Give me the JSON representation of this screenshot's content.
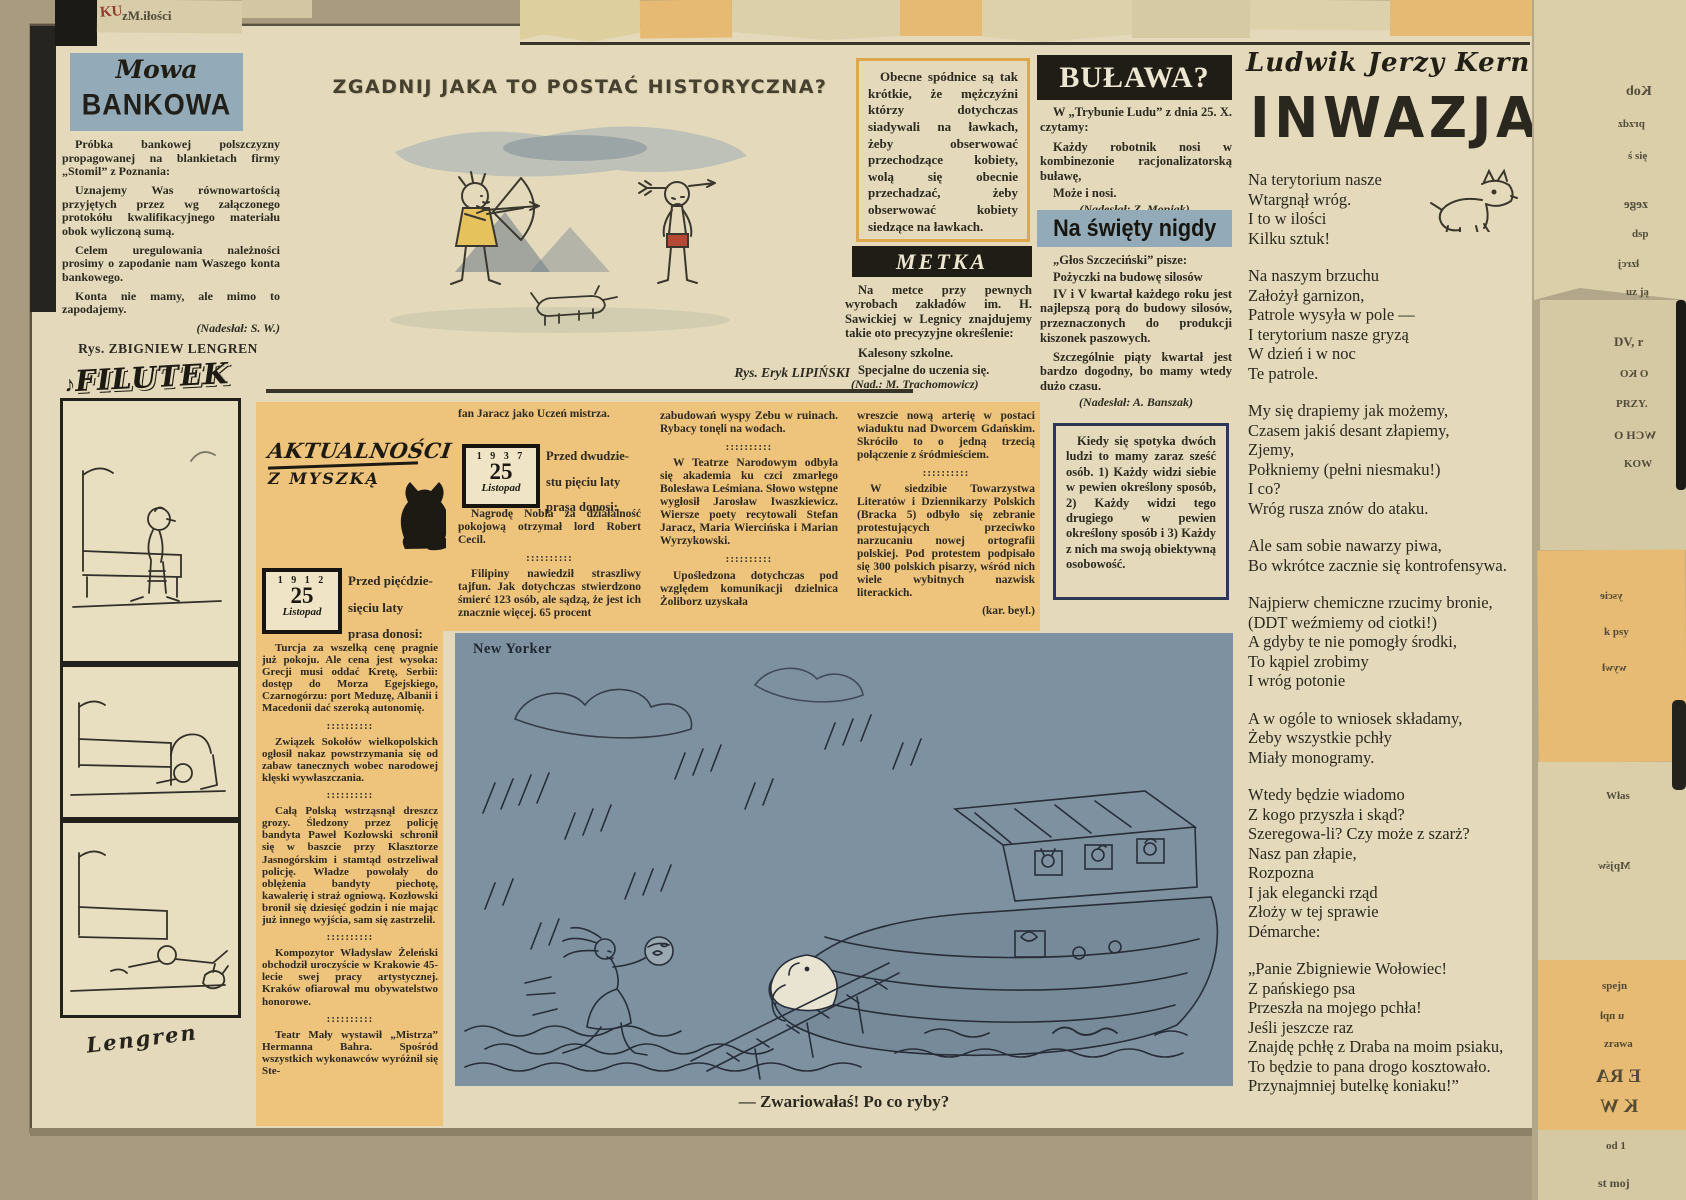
{
  "theme": {
    "paper": "#e4dabb",
    "surround": "#a89b7f",
    "orange": "#eec47d",
    "blue": "#93abb9",
    "black_bar": "#201d17",
    "cartoon_bg": "#7e91a1",
    "ink": "#2c2920",
    "navy": "#2b3850",
    "accent_border": "#dda74e"
  },
  "mowa": {
    "script": "Mowa",
    "title": "BANKOWA",
    "p1": "Próbka bankowej polszczyzny propagowanej na blankietach firmy „Stomil” z Poznania:",
    "p2": "Uznajemy Was równowartością przyjętych przez wg załączonego protokółu kwalifikacyjnego materiału obok wyliczoną sumą.",
    "p3": "Celem uregulowania należności prosimy o zapodanie nam Waszego konta bankowego.",
    "p4": "Konta nie mamy, ale mimo to zapodajemy.",
    "credit": "(Nadesłał: S. W.)",
    "rys": "Rys. ZBIGNIEW LENGREN"
  },
  "filutek": {
    "note": "♪",
    "logo": "FILUTEK",
    "signature": "Lengren"
  },
  "zgadnij": {
    "title": "ZGADNIJ JAKA TO POSTAĆ HISTORYCZNA?",
    "credit": "Rys. Eryk LIPIŃSKI"
  },
  "spodnice": {
    "text": "Obecne spódnice są tak krótkie, że mężczyźni którzy dotychczas siadywali na ławkach, żeby obserwować przechodzące kobiety, wolą się obecnie przechadzać, żeby obserwować kobiety siedzące na ławkach."
  },
  "bulawa": {
    "title": "BUŁAWA?",
    "intro": "W „Trybunie Ludu” z dnia 25. X. czytamy:",
    "quote": "Każdy robotnik nosi w kombinezonie racjonalizatorską buławę,",
    "note": "Może i nosi.",
    "credit": "(Nadesłał: Z. Moniak)."
  },
  "swiety": {
    "title": "Na święty nigdy",
    "intro": "„Głos Szczeciński” pisze:",
    "quote1": "Pożyczki na budowę silosów",
    "quote2": "IV i V kwartał każdego roku jest najlepszą porą do budowy silosów, przeznaczonych do produkcji kiszonek paszowych.",
    "note": "Szczególnie piąty kwartał jest bardzo dogodny, bo mamy wtedy dużo czasu.",
    "credit": "(Nadesłał: A. Banszak)"
  },
  "metka": {
    "title": "METKA",
    "intro": "Na metce przy pewnych wyrobach zakładów im. H. Sawickiej w Legnicy znajdujemy takie oto precyzyjne określenie:",
    "quote": "Kalesony szkolne.",
    "note": "Specjalne do uczenia się.",
    "credit": "(Nad.: M. Trachomowicz)"
  },
  "kiedy": {
    "text": "Kiedy się spotyka dwóch ludzi to mamy zaraz sześć osób. 1) Każdy widzi siebie w pewien określony sposób, 2) Każdy widzi tego drugiego w pewien określony sposób i 3) Każdy z nich ma swoją obiektywną osobowość."
  },
  "akt": {
    "logo1": "AKTUALNOŚCI",
    "logo2": "Z MYSZKĄ",
    "sep": "::::::::::",
    "cal1": {
      "year": "1 9 1 2",
      "day": "25",
      "month": "Listopad"
    },
    "intro1": "Przed pięćdzie-\nsięciu laty\nprasa donosi:",
    "col1": [
      "Turcja za wszelką cenę pragnie już pokoju. Ale cena jest wysoka: Grecji musi oddać Kretę, Serbii: dostęp do Morza Egejskiego, Czarnogórzu: port Meduzę, Albanii i Macedonii dać szeroką autonomię.",
      "Związek Sokołów wielkopolskich ogłosił nakaz powstrzymania się od zabaw tanecznych wobec narodowej klęski wywłaszczania.",
      "Całą Polską wstrząsnął dreszcz grozy. Śledzony przez policję bandyta Paweł Kozłowski schronił się w baszcie przy Klasztorze Jasnogórskim i stamtąd ostrzeliwał policję. Władze powołały do oblężenia bandyty piechotę, kawalerię i straż ogniową. Kozłowski bronił się dziesięć godzin i nie mając już innego wyjścia, sam się zastrzelił.",
      "Kompozytor Władysław Żeleński obchodził uroczyście w Krakowie 45-lecie swej pracy artystycznej. Kraków ofiarował mu obywatelstwo honorowe.",
      "Teatr Mały wystawił „Mistrza” Hermanna Bahra. Spośród wszystkich wykonawców wyróżnił się Ste-"
    ],
    "col2_lead": "fan Jaracz jako Uczeń mistrza.",
    "cal2": {
      "year": "1 9 3 7",
      "day": "25",
      "month": "Listopad"
    },
    "intro2": "Przed dwudzie-\nstu pięciu laty\nprasa donosi:",
    "col2": [
      "Nagrodę Nobla za działalność pokojową otrzymał lord Robert Cecil.",
      "Filipiny nawiedził straszliwy tajfun. Jak dotychczas stwierdzono śmierć 123 osób, ale sądzą, że jest ich znacznie więcej. 65 procent"
    ],
    "col3": [
      "zabudowań wyspy Zebu w ruinach. Rybacy tonęli na wodach.",
      "W Teatrze Narodowym odbyła się akademia ku czci zmarłego Bolesława Leśmiana. Słowo wstępne wygłosił Jarosław Iwaszkiewicz. Wiersze poety recytowali Stefan Jaracz, Maria Wiercińska i Marian Wyrzykowski.",
      "Upośledzona dotychczas pod względem komunikacji dzielnica Żoliborz uzyskała"
    ],
    "col4": [
      "wreszcie nową arterię w postaci wiaduktu nad Dworcem Gdańskim. Skróciło to o jedną trzecią połączenie z śródmieściem.",
      "W siedzibie Towarzystwa Literatów i Dziennikarzy Polskich (Bracka 5) odbyło się zebranie protestujących przeciwko narzucaniu nowej ortografii polskiej. Pod protestem podpisało się 300 polskich pisarzy, wśród nich wiele wybitnych nazwisk literackich."
    ],
    "col4_credit": "(kar. beyl.)"
  },
  "newyorker": {
    "label": "New Yorker",
    "caption": "— Zwariowałaś! Po co ryby?"
  },
  "inwazja": {
    "author": "Ludwik Jerzy Kern",
    "title": "INWAZJA",
    "stanzas": [
      "Na terytorium nasze\nWtargnął wróg.\nI to w ilości\nKilku sztuk!",
      "Na naszym brzuchu\nZałożył garnizon,\nPatrole wysyła w pole —\nI terytorium nasze gryzą\nW dzień i w noc\nTe patrole.",
      "My się drapiemy jak możemy,\nCzasem jakiś desant złapiemy,\nZjemy,\nPołkniemy (pełni niesmaku!)\nI co?\nWróg rusza znów do ataku.",
      "Ale sam sobie nawarzy piwa,\nBo wkrótce zacznie się kontrofensywa.",
      "Najpierw chemiczne rzucimy bronie,\n(DDT weźmiemy od ciotki!)\nA gdyby te nie pomogły środki,\nTo kąpiel zrobimy\nI wróg potonie",
      "A w ogóle to wniosek składamy,\nŻeby wszystkie pchły\nMiały monogramy.",
      "Wtedy będzie wiadomo\nZ kogo przyszła i skąd?\nSzeregowa-li? Czy może z szarż?\nNasz pan złapie,\nRozpozna\nI jak elegancki rząd\nZłoży w tej sprawie\nDémarche:",
      "„Panie Zbigniewie Wołowiec!\nZ pańskiego psa\nPrzeszła na mojego pchła!\nJeśli jeszcze raz\nZnajdę pchłę z Draba na moim psiaku,\nTo będzie to pana drogo kosztowało.\nPrzynajmniej butelkę koniaku!”"
    ]
  },
  "edges": {
    "frags": [
      "KU",
      "zM.iłości",
      "Kob",
      "przdz",
      "ś się",
      "zege",
      "dsp",
      "łzrcj",
      "uz ją",
      "DV, r",
      "O KO",
      "PRZY.",
      "WCH O",
      "KOW",
      "yscie",
      "k psy",
      "wywł",
      "Włas",
      "Mpjśw",
      "spejn",
      "u npł",
      "zrawa",
      "E RA",
      "K W",
      "od 1",
      "st moj"
    ]
  }
}
